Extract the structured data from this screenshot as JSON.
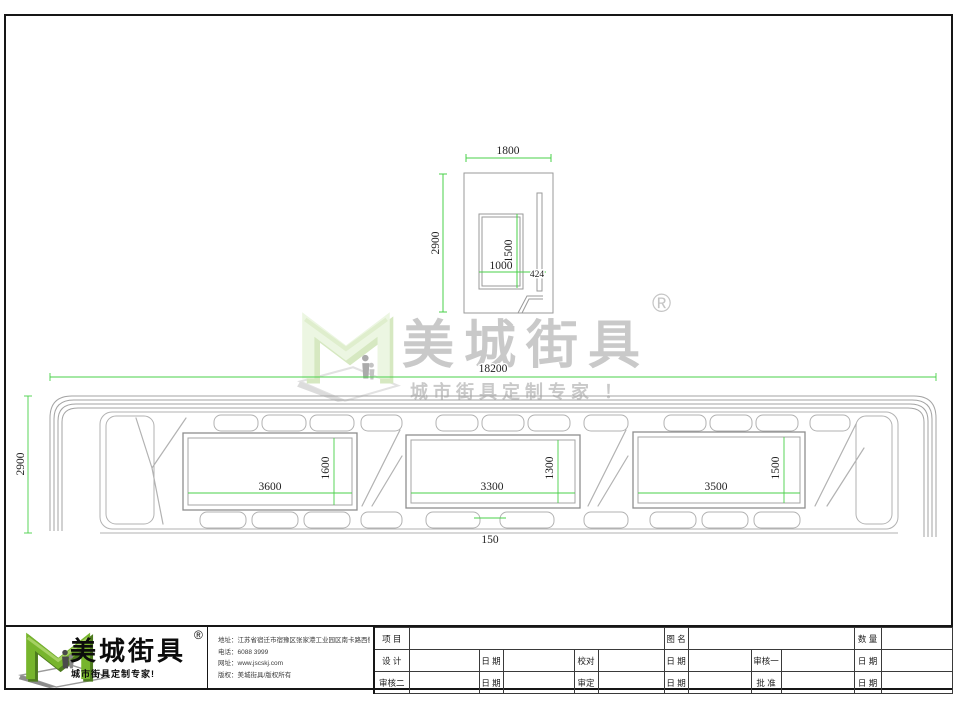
{
  "watermark": {
    "brand": "美城街具",
    "reg": "®",
    "tagline": "城市街具定制专家 ！"
  },
  "side_view": {
    "width_dim": "1800",
    "height_dim": "2900",
    "panel_height_dim": "1500",
    "panel_width_dim": "1000",
    "offset_dim": "424"
  },
  "elevation": {
    "total_width_dim": "18200",
    "height_dim": "2900",
    "gap_dim": "150",
    "panel1": {
      "width_dim": "3600",
      "height_dim": "1600"
    },
    "panel2": {
      "width_dim": "3300",
      "height_dim": "1300"
    },
    "panel3": {
      "width_dim": "3500",
      "height_dim": "1500"
    }
  },
  "title_block": {
    "brand": "美城街具",
    "reg": "®",
    "tagline": "城市街具定制专家!",
    "info": {
      "address": "地址：江苏省宿迁市宿豫区张家港工业园区南卡路西侧1号",
      "phone": "电话：6088 3999",
      "website": "网址：www.jscskj.com",
      "copyright": "版权：美城街具/版权所有"
    },
    "table": {
      "project": "项 目",
      "drawing_name": "图 名",
      "quantity": "数 量",
      "design": "设 计",
      "date": "日 期",
      "proofread": "校对",
      "review1": "审核一",
      "review2": "审核二",
      "approve": "审定",
      "ratify": "批 准"
    }
  },
  "colors": {
    "dim_green": "#49d049",
    "line_gray": "#a8a8a8",
    "logo_green": "#77b52d",
    "logo_green_dark": "#4d7b1e",
    "watermark_green": "#e9f4de"
  }
}
